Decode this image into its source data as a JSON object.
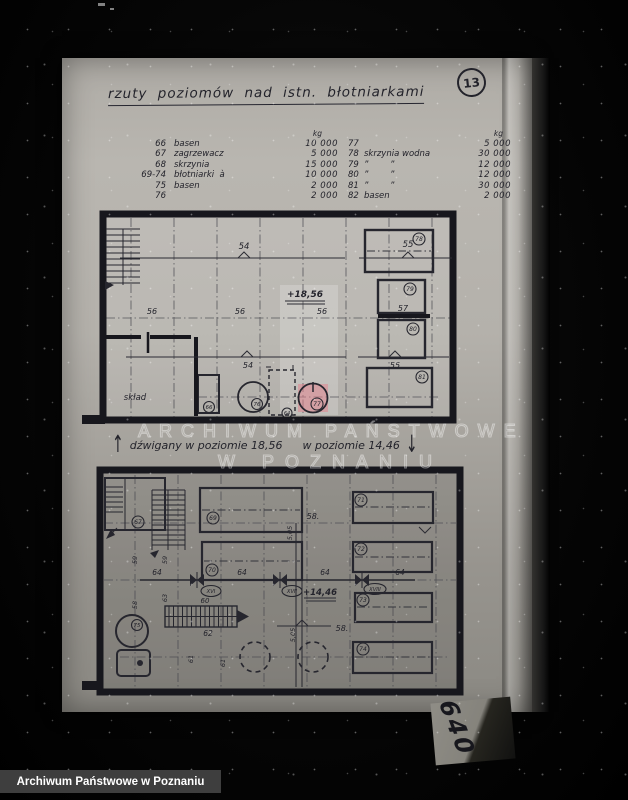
{
  "page": {
    "number": "13"
  },
  "title": "rzuty poziomów nad istn. błotniarkami",
  "legend": {
    "unit": "kg",
    "rows_left": [
      {
        "no": "66",
        "name": "basen",
        "value": "10 000"
      },
      {
        "no": "67",
        "name": "zagrzewacz",
        "value": "5 000"
      },
      {
        "no": "68",
        "name": "skrzynia",
        "value": "15 000"
      },
      {
        "no": "69-74",
        "name": "błotniarki  à",
        "value": "10 000"
      },
      {
        "no": "75",
        "name": "basen",
        "value": "2 000"
      },
      {
        "no": "76",
        "name": "",
        "value": "2 000"
      }
    ],
    "rows_right": [
      {
        "no": "77",
        "name": "",
        "value": "5 000"
      },
      {
        "no": "78",
        "name": "skrzynia wodna",
        "value": "30 000"
      },
      {
        "no": "79",
        "name": "”        ”",
        "value": "12 000"
      },
      {
        "no": "80",
        "name": "”        ”",
        "value": "12 000"
      },
      {
        "no": "81",
        "name": "”        ”",
        "value": "30 000"
      },
      {
        "no": "82",
        "name": "basen",
        "value": "2 000"
      }
    ]
  },
  "upper_plan": {
    "dims": {
      "d54": "54",
      "d55": "55",
      "d56": "56",
      "d57": "57",
      "d64": "64"
    },
    "elevation": "+18,56",
    "room": "skład",
    "tanks": {
      "t66": "66",
      "t76": "76",
      "t77": "77",
      "t78": "78",
      "t79": "79",
      "t80": "80",
      "t81": "81"
    }
  },
  "caption": {
    "arrow_up": "↑",
    "left": "dźwigany w poziomie 18,56",
    "right": "w poziomie 14,46",
    "arrow_down": "↓"
  },
  "lower_plan": {
    "dims": {
      "d58": "58.",
      "d58r": "58",
      "d59": "59",
      "d60": "60",
      "d61": "61",
      "d62": "62",
      "d63": "63",
      "d64": "64",
      "d505": "5,05"
    },
    "elevation": "+14,46",
    "tanks": {
      "t67": "67",
      "t69": "69",
      "t70": "70",
      "t71": "71",
      "t72": "72",
      "t73": "73",
      "t74": "74",
      "t75": "75"
    },
    "valves": [
      "XVI",
      "XVII",
      "XVIII"
    ]
  },
  "watermark": {
    "line1": "ARCHIWUM PAŃSTWOWE",
    "line2": "W POZNANIU"
  },
  "scrap": {
    "text": "640"
  },
  "footer": {
    "label": "Archiwum Państwowe w Poznaniu"
  }
}
